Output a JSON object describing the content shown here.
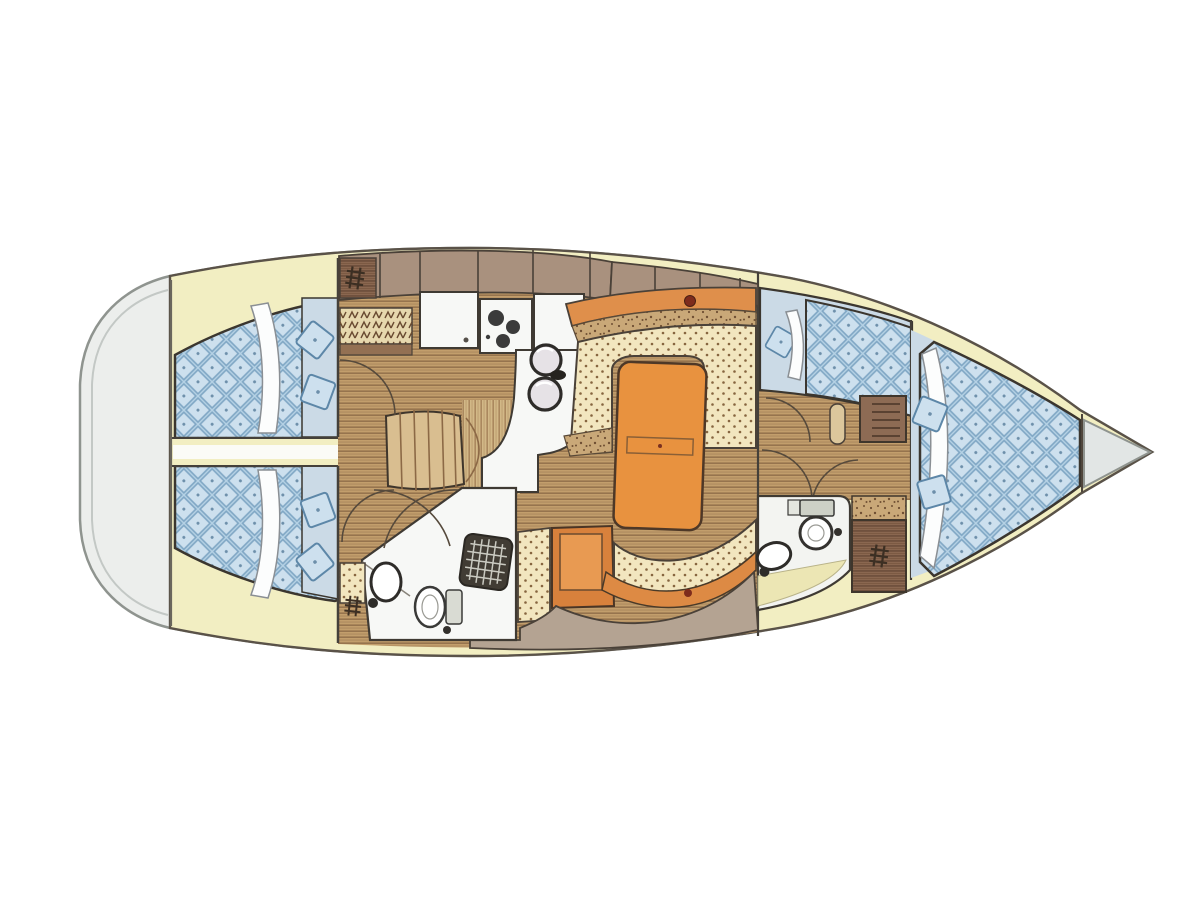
{
  "image": {
    "kind": "sailing-yacht-interior-layout-floor-plan",
    "view": "top-down",
    "bow_direction": "right",
    "stern_direction": "left",
    "background": "#ffffff"
  },
  "colors": {
    "outline": "#5a5248",
    "hullline": "#8f948f",
    "deck": "#f2eec2",
    "hull_gray": "#eceeec",
    "berth_blue": "#b7d3e6",
    "settee_cream": "#f2e6bf",
    "table_orange": "#e8923f",
    "backrest_orange": "#df8f4b",
    "wood": "#c29e6c",
    "cabinet_brown": "#8a6750",
    "cabinet_mauve": "#a9917e",
    "fixture_white": "#f7f8f6",
    "accent_red": "#7e2c1c",
    "bow_floor_blue": "#cbdae6",
    "taupe": "#b4a392",
    "dark": "#3f3a33"
  },
  "areas": [
    {
      "id": "stern-platform",
      "depicts": "rounded stern / lazarette area"
    },
    {
      "id": "aft-cabin-port",
      "depicts": "double berth, quilted mattress, blanket fold, two pillows"
    },
    {
      "id": "aft-cabin-starboard",
      "depicts": "double berth, quilted mattress, blanket fold, two pillows"
    },
    {
      "id": "center-corridor",
      "depicts": "walkway between aft cabins to companionway steps"
    },
    {
      "id": "companionway-steps",
      "depicts": "steps down from cockpit"
    },
    {
      "id": "galley",
      "depicts": "counters, fridge, three-burner stove, double round sinks, bottle rack"
    },
    {
      "id": "salon",
      "depicts": "U-shaped settee, orange dining table, bench settee, armchair"
    },
    {
      "id": "head-aft",
      "depicts": "toilet, round washbasin, shower grate"
    },
    {
      "id": "head-forward",
      "depicts": "toilet, oval washbasin, yellow sole"
    },
    {
      "id": "forward-passage",
      "depicts": "doors and lockers leading forward"
    },
    {
      "id": "pullman-berth",
      "depicts": "quilted single berth with pillow along port side"
    },
    {
      "id": "wardrobe-forward",
      "depicts": "hanging locker with ladder symbol"
    },
    {
      "id": "bow-cabin",
      "depicts": "large quilted V-berth with blanket fold and cushions"
    },
    {
      "id": "anchor-locker",
      "depicts": "grey triangle at bow tip"
    }
  ]
}
